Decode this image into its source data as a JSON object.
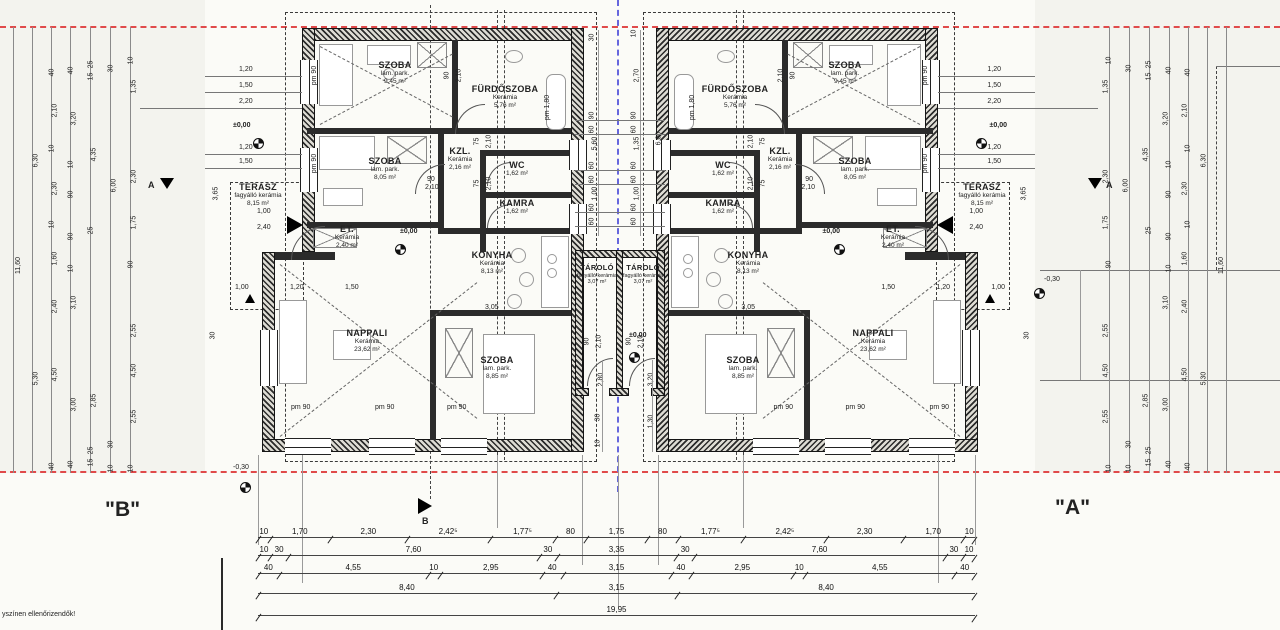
{
  "sheet": {
    "unit_b_label": "\"B\"",
    "unit_a_label": "\"A\"",
    "note": "yszínen ellenőrizendők!",
    "minus_level_left": "-0,30",
    "minus_level_right": "-0,30",
    "section_label_a": "A",
    "section_label_b": "B",
    "total_dim": "19,95"
  },
  "colors": {
    "plot_boundary_red": "#e04a4a",
    "division_blue": "#6666dd",
    "wall_dark": "#1c1c1c"
  },
  "units": [
    {
      "id": "B",
      "level": "±0,00",
      "window_label": "pm 90",
      "tub_label": "pm 1,80",
      "door_w90": "90",
      "door_w75": "75",
      "door_h": "2,10",
      "konyha_opening": "3,05",
      "terasz_dims": {
        "h": "3,65",
        "step": "30",
        "a": "1,00",
        "b": "2,40"
      },
      "approach_top": [
        {
          "t": "1,20",
          "y": 54
        },
        {
          "t": "1,50",
          "y": 70
        },
        {
          "t": "2,20",
          "y": 86
        }
      ],
      "approach_bottom": [
        {
          "t": "1,20",
          "y": 132
        },
        {
          "t": "1,50",
          "y": 146
        }
      ],
      "nappali_row": [
        {
          "t": "1,00",
          "x": 30
        },
        {
          "t": "1,20",
          "x": 85
        },
        {
          "t": "1,50",
          "x": 140
        }
      ],
      "rooms": {
        "szoba_top": {
          "name": "SZOBA",
          "finish": "lam. park.",
          "area": "9,45 m²"
        },
        "furdoszoba": {
          "name": "FÜRDŐSZOBA",
          "finish": "Kerámia",
          "area": "5,76 m²"
        },
        "szoba_mid": {
          "name": "SZOBA",
          "finish": "lam. park.",
          "area": "8,05 m²"
        },
        "kzl": {
          "name": "KZL.",
          "finish": "Kerámia",
          "area": "2,16 m²"
        },
        "wc": {
          "name": "WC",
          "finish": "Kerámia",
          "area": "1,62 m²"
        },
        "kamra": {
          "name": "KAMRA",
          "finish": "Kerámia",
          "area": "1,62 m²"
        },
        "et": {
          "name": "ET.",
          "finish": "Kerámia",
          "area": "2,40 m²"
        },
        "konyha": {
          "name": "KONYHA",
          "finish": "Kerámia",
          "area": "8,13 m²"
        },
        "nappali": {
          "name": "NAPPALI",
          "finish": "Kerámia",
          "area": "23,62 m²"
        },
        "szoba_bottom": {
          "name": "SZOBA",
          "finish": "lam. park.",
          "area": "8,85 m²"
        },
        "terasz": {
          "name": "TERASZ",
          "finish": "fagyálló kerámia",
          "area": "8,15 m²"
        }
      }
    },
    {
      "id": "A",
      "level": "±0,00",
      "window_label": "pm 90",
      "tub_label": "pm 1,80",
      "door_w90": "90",
      "door_w75": "75",
      "door_h": "2,10",
      "konyha_opening": "3,05",
      "terasz_dims": {
        "h": "3,65",
        "step": "30",
        "a": "1,00",
        "b": "2,40"
      },
      "approach_top": [
        {
          "t": "1,20",
          "y": 54
        },
        {
          "t": "1,50",
          "y": 70
        },
        {
          "t": "2,20",
          "y": 86
        }
      ],
      "approach_bottom": [
        {
          "t": "1,20",
          "y": 132
        },
        {
          "t": "1,50",
          "y": 146
        }
      ],
      "nappali_row": [
        {
          "t": "1,00",
          "x": 30
        },
        {
          "t": "1,20",
          "x": 85
        },
        {
          "t": "1,50",
          "x": 140
        }
      ],
      "rooms": {
        "szoba_top": {
          "name": "SZOBA",
          "finish": "lam. park.",
          "area": "9,45 m²"
        },
        "furdoszoba": {
          "name": "FÜRDŐSZOBA",
          "finish": "Kerámia",
          "area": "5,76 m²"
        },
        "szoba_mid": {
          "name": "SZOBA",
          "finish": "lam. park.",
          "area": "8,05 m²"
        },
        "kzl": {
          "name": "KZL.",
          "finish": "Kerámia",
          "area": "2,16 m²"
        },
        "wc": {
          "name": "WC",
          "finish": "Kerámia",
          "area": "1,62 m²"
        },
        "kamra": {
          "name": "KAMRA",
          "finish": "Kerámia",
          "area": "1,62 m²"
        },
        "et": {
          "name": "ET.",
          "finish": "Kerámia",
          "area": "2,40 m²"
        },
        "konyha": {
          "name": "KONYHA",
          "finish": "Kerámia",
          "area": "8,13 m²"
        },
        "nappali": {
          "name": "NAPPALI",
          "finish": "Kerámia",
          "area": "23,62 m²"
        },
        "szoba_bottom": {
          "name": "SZOBA",
          "finish": "lam. park.",
          "area": "8,85 m²"
        },
        "terasz": {
          "name": "TERASZ",
          "finish": "fagyálló kerámia",
          "area": "8,15 m²"
        }
      }
    }
  ],
  "stores": {
    "left": {
      "name": "TÁROLÓ",
      "finish": "fagyálló kerámia",
      "area": "3,07 m²"
    },
    "right": {
      "name": "TÁROLÓ",
      "finish": "fagyálló kerámia",
      "area": "3,07 m²"
    },
    "door_w": "90",
    "door_h": "2,10",
    "level": "±0,00"
  },
  "dims": {
    "bottom_rows": {
      "r1": [
        {
          "t": "10",
          "w": 0.1
        },
        {
          "t": "1,70",
          "w": 1.7
        },
        {
          "t": "2,30",
          "w": 2.3
        },
        {
          "t": "2,42⁵",
          "w": 2.425
        },
        {
          "t": "1,77⁵",
          "w": 1.775
        },
        {
          "t": "80",
          "w": 0.8
        },
        {
          "t": "1,75",
          "w": 1.75
        },
        {
          "t": "80",
          "w": 0.8
        },
        {
          "t": "1,77⁵",
          "w": 1.775
        },
        {
          "t": "2,42⁵",
          "w": 2.425
        },
        {
          "t": "2,30",
          "w": 2.3
        },
        {
          "t": "1,70",
          "w": 1.7
        },
        {
          "t": "10",
          "w": 0.1
        }
      ],
      "r2": [
        {
          "t": "10",
          "w": 0.1
        },
        {
          "t": "30",
          "w": 0.3
        },
        {
          "t": "7,60",
          "w": 7.6
        },
        {
          "t": "30",
          "w": 0.3
        },
        {
          "t": "3,35",
          "w": 3.35
        },
        {
          "t": "30",
          "w": 0.3
        },
        {
          "t": "7,60",
          "w": 7.6
        },
        {
          "t": "30",
          "w": 0.3
        },
        {
          "t": "10",
          "w": 0.1
        }
      ],
      "r3": [
        {
          "t": "40",
          "w": 0.4
        },
        {
          "t": "4,55",
          "w": 4.55
        },
        {
          "t": "10",
          "w": 0.1
        },
        {
          "t": "2,95",
          "w": 2.95
        },
        {
          "t": "40",
          "w": 0.4
        },
        {
          "t": "3,15",
          "w": 3.15
        },
        {
          "t": "40",
          "w": 0.4
        },
        {
          "t": "2,95",
          "w": 2.95
        },
        {
          "t": "10",
          "w": 0.1
        },
        {
          "t": "4,55",
          "w": 4.55
        },
        {
          "t": "40",
          "w": 0.4
        }
      ],
      "r4": [
        {
          "t": "8,40",
          "w": 8.4
        },
        {
          "t": "3,15",
          "w": 3.15
        },
        {
          "t": "8,40",
          "w": 8.4
        }
      ],
      "r5": [
        {
          "t": "19,95",
          "w": 19.95
        }
      ]
    },
    "side_cols": {
      "c0": [
        {
          "t": "11,60",
          "y": 235
        }
      ],
      "c1": [
        {
          "t": "6,30",
          "y": 130
        },
        {
          "t": "5,30",
          "y": 348
        }
      ],
      "c2": [
        {
          "t": "40",
          "y": 42
        },
        {
          "t": "2,10",
          "y": 80
        },
        {
          "t": "10",
          "y": 118
        },
        {
          "t": "2,30",
          "y": 158
        },
        {
          "t": "10",
          "y": 194
        },
        {
          "t": "1,60",
          "y": 228
        },
        {
          "t": "2,40",
          "y": 276
        },
        {
          "t": "4,50",
          "y": 344
        },
        {
          "t": "40",
          "y": 436
        }
      ],
      "c3": [
        {
          "t": "40",
          "y": 40
        },
        {
          "t": "3,20",
          "y": 88
        },
        {
          "t": "10",
          "y": 134
        },
        {
          "t": "90",
          "y": 164
        },
        {
          "t": "90",
          "y": 206
        },
        {
          "t": "10",
          "y": 238
        },
        {
          "t": "3,10",
          "y": 272
        },
        {
          "t": "3,00",
          "y": 374
        },
        {
          "t": "40",
          "y": 434
        }
      ],
      "c4": [
        {
          "t": "25",
          "y": 34
        },
        {
          "t": "15",
          "y": 46
        },
        {
          "t": "4,35",
          "y": 124
        },
        {
          "t": "25",
          "y": 200
        },
        {
          "t": "2,85",
          "y": 370
        },
        {
          "t": "25",
          "y": 420
        },
        {
          "t": "15",
          "y": 432
        }
      ],
      "c5": [
        {
          "t": "30",
          "y": 38
        },
        {
          "t": "6,00",
          "y": 155
        },
        {
          "t": "30",
          "y": 414
        },
        {
          "t": "10",
          "y": 438
        }
      ],
      "c6": [
        {
          "t": "10",
          "y": 30
        },
        {
          "t": "1,35",
          "y": 56
        },
        {
          "t": "2,30",
          "y": 146
        },
        {
          "t": "1,75",
          "y": 192
        },
        {
          "t": "90",
          "y": 234
        },
        {
          "t": "2,55",
          "y": 300
        },
        {
          "t": "4,50",
          "y": 340
        },
        {
          "t": "2,55",
          "y": 386
        },
        {
          "t": "10",
          "y": 438
        }
      ]
    },
    "mid_cols": {
      "m0": [
        {
          "t": "30",
          "y": 34
        },
        {
          "t": "90",
          "y": 112
        },
        {
          "t": "60",
          "y": 126
        },
        {
          "t": "5,60",
          "y": 140
        },
        {
          "t": "60",
          "y": 162
        },
        {
          "t": "60",
          "y": 176
        },
        {
          "t": "1,00",
          "y": 190
        },
        {
          "t": "60",
          "y": 204
        },
        {
          "t": "60",
          "y": 218
        }
      ],
      "m1": [
        {
          "t": "10",
          "y": 30
        },
        {
          "t": "2,70",
          "y": 72
        },
        {
          "t": "90",
          "y": 112
        },
        {
          "t": "60",
          "y": 126
        },
        {
          "t": "1,35",
          "y": 140
        },
        {
          "t": "60",
          "y": 162
        },
        {
          "t": "60",
          "y": 176
        },
        {
          "t": "1,00",
          "y": 190
        },
        {
          "t": "60",
          "y": 204
        },
        {
          "t": "60",
          "y": 218
        }
      ],
      "m2": [
        {
          "t": "6,00",
          "y": 135
        }
      ],
      "mb0": [
        {
          "t": "2,80",
          "y": 376
        },
        {
          "t": "30",
          "y": 414
        },
        {
          "t": "10",
          "y": 440
        }
      ],
      "mb1": [
        {
          "t": "3,20",
          "y": 376
        },
        {
          "t": "1,30",
          "y": 418
        }
      ]
    }
  }
}
